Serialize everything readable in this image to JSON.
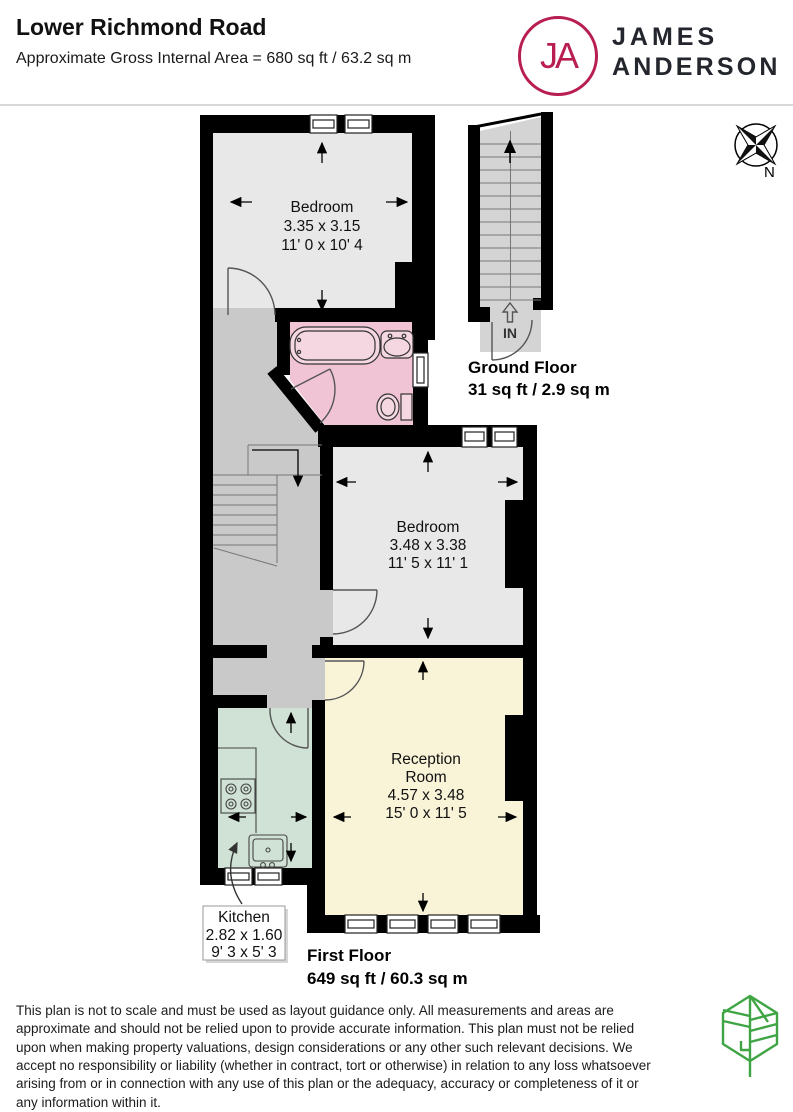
{
  "header": {
    "title": "Lower Richmond Road",
    "subtitle": "Approximate Gross Internal Area = 680 sq ft / 63.2 sq m"
  },
  "brand": {
    "monogram": "JA",
    "line1": "JAMES",
    "line2": "ANDERSON",
    "accent": "#b81e4f",
    "ink": "#23262d"
  },
  "compass": {
    "north": "N"
  },
  "plan": {
    "bedroom1": {
      "name": "Bedroom",
      "metric": "3.35 x 3.15",
      "imperial": "11' 0 x 10' 4"
    },
    "bedroom2": {
      "name": "Bedroom",
      "metric": "3.48 x 3.38",
      "imperial": "11' 5 x 11' 1"
    },
    "reception": {
      "name1": "Reception",
      "name2": "Room",
      "metric": "4.57 x 3.48",
      "imperial": "15' 0 x 11' 5"
    },
    "kitchen": {
      "name": "Kitchen",
      "metric": "2.82 x 1.60",
      "imperial": "9' 3 x 5' 3"
    },
    "entrance": "IN",
    "ground_floor": {
      "name": "Ground Floor",
      "area": "31 sq ft / 2.9 sq m"
    },
    "first_floor": {
      "name": "First Floor",
      "area": "649 sq ft / 60.3 sq m"
    },
    "colors": {
      "bedroom": "#e8e8e8",
      "bathroom": "#f0c4d4",
      "bath_fixture": "#f5d7e1",
      "hallway": "#c9c9c9",
      "kitchen": "#d0e2d5",
      "reception": "#f9f3d8",
      "stairs": "#d4d4d4",
      "wall": "#000000"
    }
  },
  "footer": {
    "disclaimer": "This plan is not to scale and must be used as layout guidance only. All measurements and areas are approximate and should not be relied upon to provide accurate information. This plan must not be relied upon when making property valuations, design considerations or any other such relevant decisions. We accept no responsibility or liability (whether in contract, tort or otherwise) in relation to any loss whatsoever arising from or in connection with any use of this plan or the adequacy, accuracy or completeness of it or any information within it.",
    "leaf_color": "#3fa544"
  }
}
